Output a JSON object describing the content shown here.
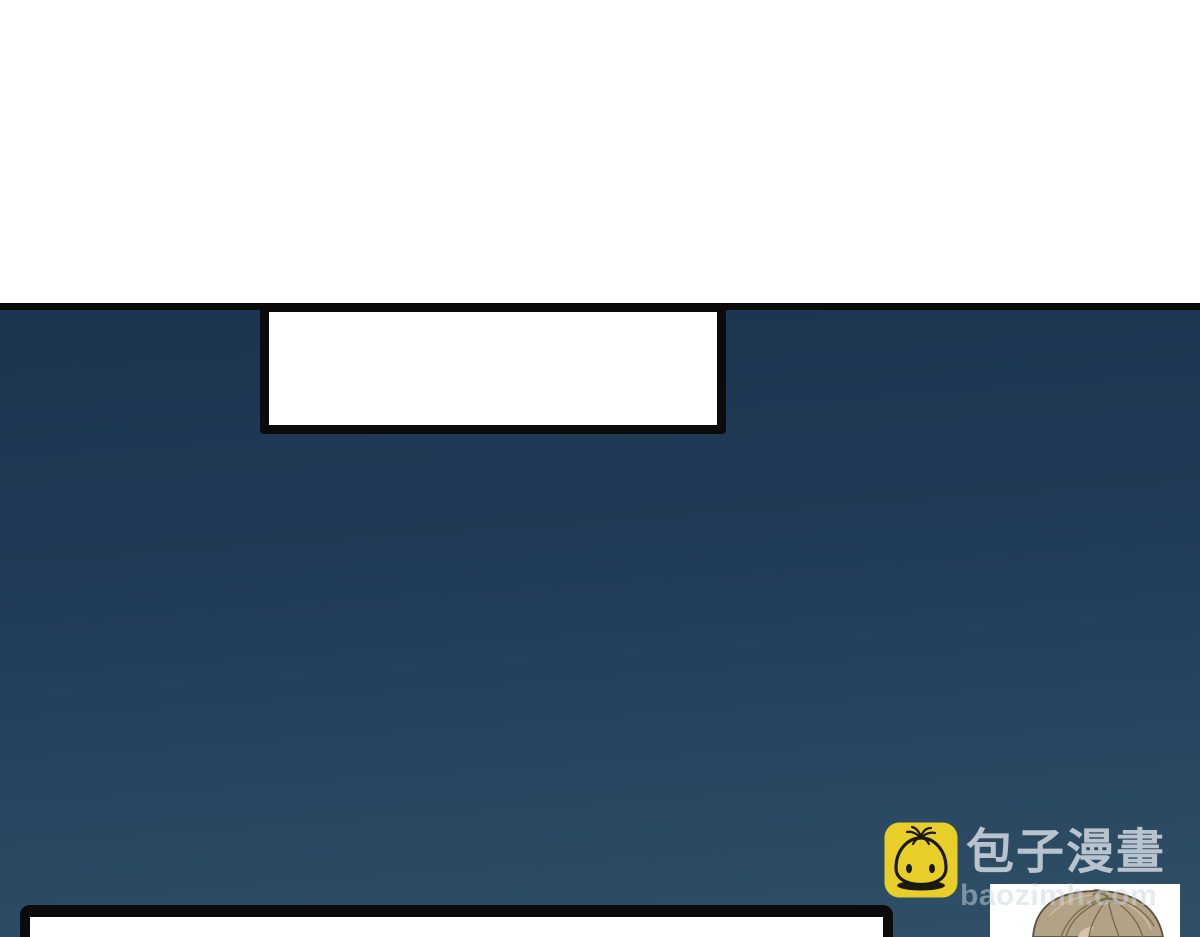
{
  "page": {
    "kind": "webtoon-comic-page",
    "background_color": "#FFFFFF"
  },
  "panel": {
    "border_color": "#0B0B0B",
    "bg_top_color": "#1D3450",
    "bg_bottom_color": "#2F5067"
  },
  "speech_boxes": [
    {
      "id": "top-speech-box",
      "text": ""
    },
    {
      "id": "bottom-speech-box",
      "text": ""
    }
  ],
  "character": {
    "label": "character-head-top",
    "hair_color": "#B2A286",
    "hair_line_color": "#6E5F4A",
    "panel_bg": "#FFFFFF"
  },
  "watermark": {
    "brand": "包子漫畫",
    "url": "baozimh.com",
    "icon": "baozi-bun-icon",
    "icon_bg_color": "#E8CE29",
    "icon_line_color": "#1A1A10",
    "brand_text_color": "#D1D8DF",
    "url_text_color": "#9FAEBA"
  }
}
